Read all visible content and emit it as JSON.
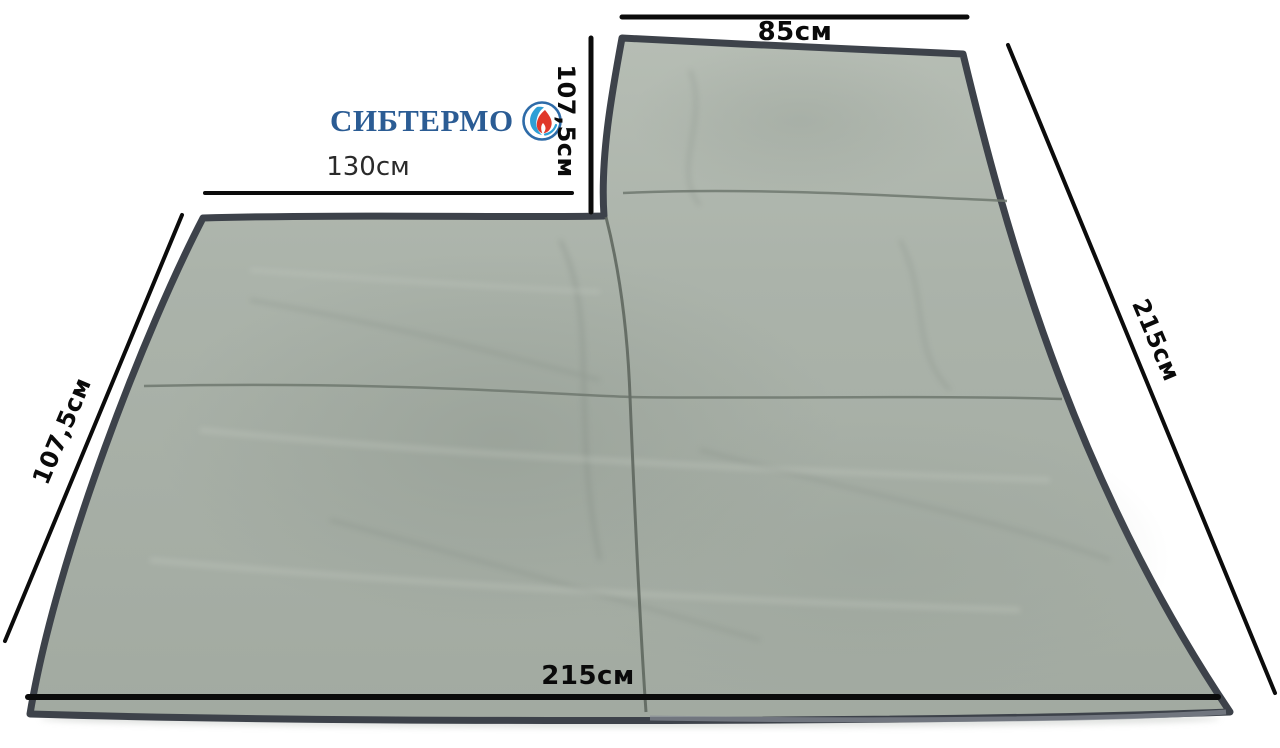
{
  "page": {
    "background": "#ffffff",
    "description": "Tent floor mat product photo with dimension annotations"
  },
  "brand": {
    "logo_text": "СИБТЕРМО",
    "logo_color": "#2b5c94",
    "icon": "flame-drop-circle-icon",
    "icon_colors": {
      "ring_blue": "#2e6ba8",
      "drop_blue": "#2f9fd6",
      "flame_red": "#e0382a"
    }
  },
  "product": {
    "fabric_color": "#aab2a9",
    "fabric_light": "#b6bdb4",
    "fabric_dark": "#a0a89f",
    "binding_color": "#3d424a",
    "seam_color": "#6f786f"
  },
  "annotations": {
    "top_width": "85см",
    "flap_height": "107,5см",
    "notch_width": "130см",
    "right_side": "215см",
    "left_side": "107,5см",
    "bottom_width": "215см"
  }
}
